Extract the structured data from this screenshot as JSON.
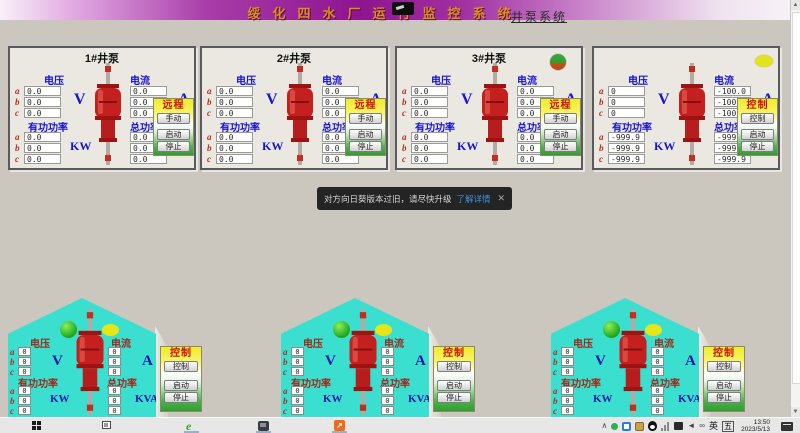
{
  "window": {
    "title": "绥化四水厂运行监控系统",
    "subtitle": "井泵系统"
  },
  "shared": {
    "voltage_label": "电压",
    "current_label": "电流",
    "active_power_label": "有功功率",
    "total_power_label": "总功率",
    "unit_v": "V",
    "unit_a": "A",
    "unit_kw": "KW",
    "unit_kva": "KVA",
    "phase_a": "a",
    "phase_b": "b",
    "phase_c": "c",
    "start_label": "启动",
    "stop_label": "停止"
  },
  "pump_panels": [
    {
      "title": "1#井泵",
      "mode_label": "远程",
      "mode_button": "手动",
      "voltage": [
        "0.0",
        "0.0",
        "0.0"
      ],
      "current": [
        "0.0",
        "0.0",
        "0.0"
      ],
      "active_power": [
        "0.0",
        "0.0",
        "0.0"
      ],
      "total_power": [
        "0.0",
        "0.0",
        "0.0"
      ]
    },
    {
      "title": "2#井泵",
      "mode_label": "远程",
      "mode_button": "手动",
      "voltage": [
        "0.0",
        "0.0",
        "0.0"
      ],
      "current": [
        "0.0",
        "0.0",
        "0.0"
      ],
      "active_power": [
        "0.0",
        "0.0",
        "0.0"
      ],
      "total_power": [
        "0.0",
        "0.0",
        "0.0"
      ]
    },
    {
      "title": "3#井泵",
      "mode_label": "远程",
      "mode_button": "手动",
      "indicator_color": "green-red",
      "voltage": [
        "0.0",
        "0.0",
        "0.0"
      ],
      "current": [
        "0.0",
        "0.0",
        "0.0"
      ],
      "active_power": [
        "0.0",
        "0.0",
        "0.0"
      ],
      "total_power": [
        "0.0",
        "0.0",
        "0.0"
      ]
    },
    {
      "title": "",
      "mode_label": "控制",
      "mode_button": "控制",
      "indicator_color": "yellow",
      "voltage": [
        "0",
        "0",
        "0"
      ],
      "current": [
        "-100.0",
        "-100.0",
        "-100.0"
      ],
      "active_power": [
        "-999.9",
        "-999.9",
        "-999.9"
      ],
      "total_power": [
        "-999.9",
        "-999.9",
        "-999.9"
      ]
    }
  ],
  "house_panels": [
    {
      "mode_label": "控制",
      "mode_button": "控制",
      "voltage": [
        "0",
        "0",
        "0"
      ],
      "current": [
        "0",
        "0",
        "0"
      ],
      "active_power": [
        "0",
        "0",
        "0"
      ],
      "total_power": [
        "0",
        "0",
        "0"
      ]
    },
    {
      "mode_label": "控制",
      "mode_button": "控制",
      "voltage": [
        "0",
        "0",
        "0"
      ],
      "current": [
        "0",
        "0",
        "0"
      ],
      "active_power": [
        "0",
        "0",
        "0"
      ],
      "total_power": [
        "0",
        "0",
        "0"
      ]
    },
    {
      "mode_label": "控制",
      "mode_button": "控制",
      "voltage": [
        "0",
        "0",
        "0"
      ],
      "current": [
        "0",
        "0",
        "0"
      ],
      "active_power": [
        "0",
        "0",
        "0"
      ],
      "total_power": [
        "0",
        "0",
        "0"
      ]
    }
  ],
  "toast": {
    "message": "对方向日葵版本过旧，请尽快升级",
    "link_label": "了解详情",
    "close_label": "✕"
  },
  "taskbar": {
    "time": "13:50",
    "date": "2023/5/13",
    "ime_lang": "英",
    "ime_mode": "五"
  },
  "colors": {
    "title_bar_purple": "#8f148f",
    "title_text_gold": "#e09018",
    "panel_label_blue": "#1515cf",
    "phase_red": "#b03020",
    "pump_red": "#c42020",
    "mode_red": "#d01010",
    "control_yellow": "#f0ec28",
    "control_green": "#2e9e2e",
    "house_cyan": "#3bdfd0",
    "indicator_green": "#1fa51f",
    "indicator_yellow": "#e6e616",
    "toast_bg": "#242424",
    "toast_link_blue": "#3f8fdf"
  }
}
